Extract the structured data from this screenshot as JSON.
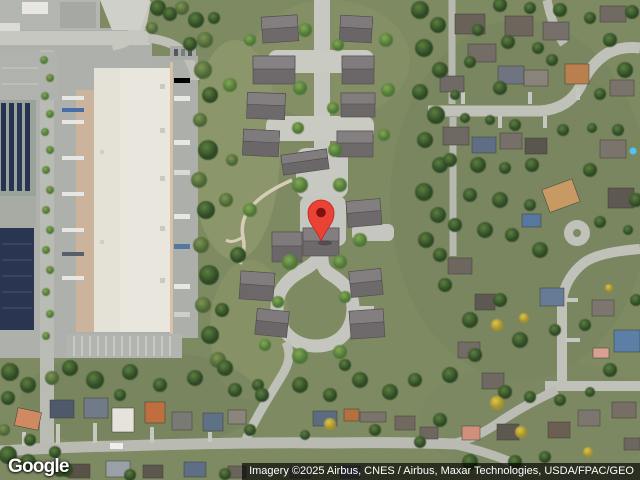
{
  "map": {
    "view_type": "satellite",
    "logo_text": "Google",
    "attribution_text": "Imagery ©2025 Airbus, CNES / Airbus, Maxar Technologies, USDA/FPAC/GEO",
    "marker": {
      "label": "location-pin",
      "color": "#EA4335",
      "outline_color": "#C5221F",
      "inner_dot_color": "#7E120D"
    },
    "colors": {
      "grass": "#7e8a62",
      "road": "#c2c4bc",
      "concrete_court": "#c9cac2",
      "warehouse_roof": "#e9e6dd",
      "loading_dock": "#cbb49b",
      "townhouse_roof": "#6e696b",
      "solar_array": "#273253",
      "tree_dark": "#3c5a2e",
      "tree_bright": "#5f8b43",
      "tree_autumn": "#c9b33a",
      "attribution_bg": "rgba(0,0,0,0.66)",
      "attribution_fg": "#ffffff"
    }
  }
}
